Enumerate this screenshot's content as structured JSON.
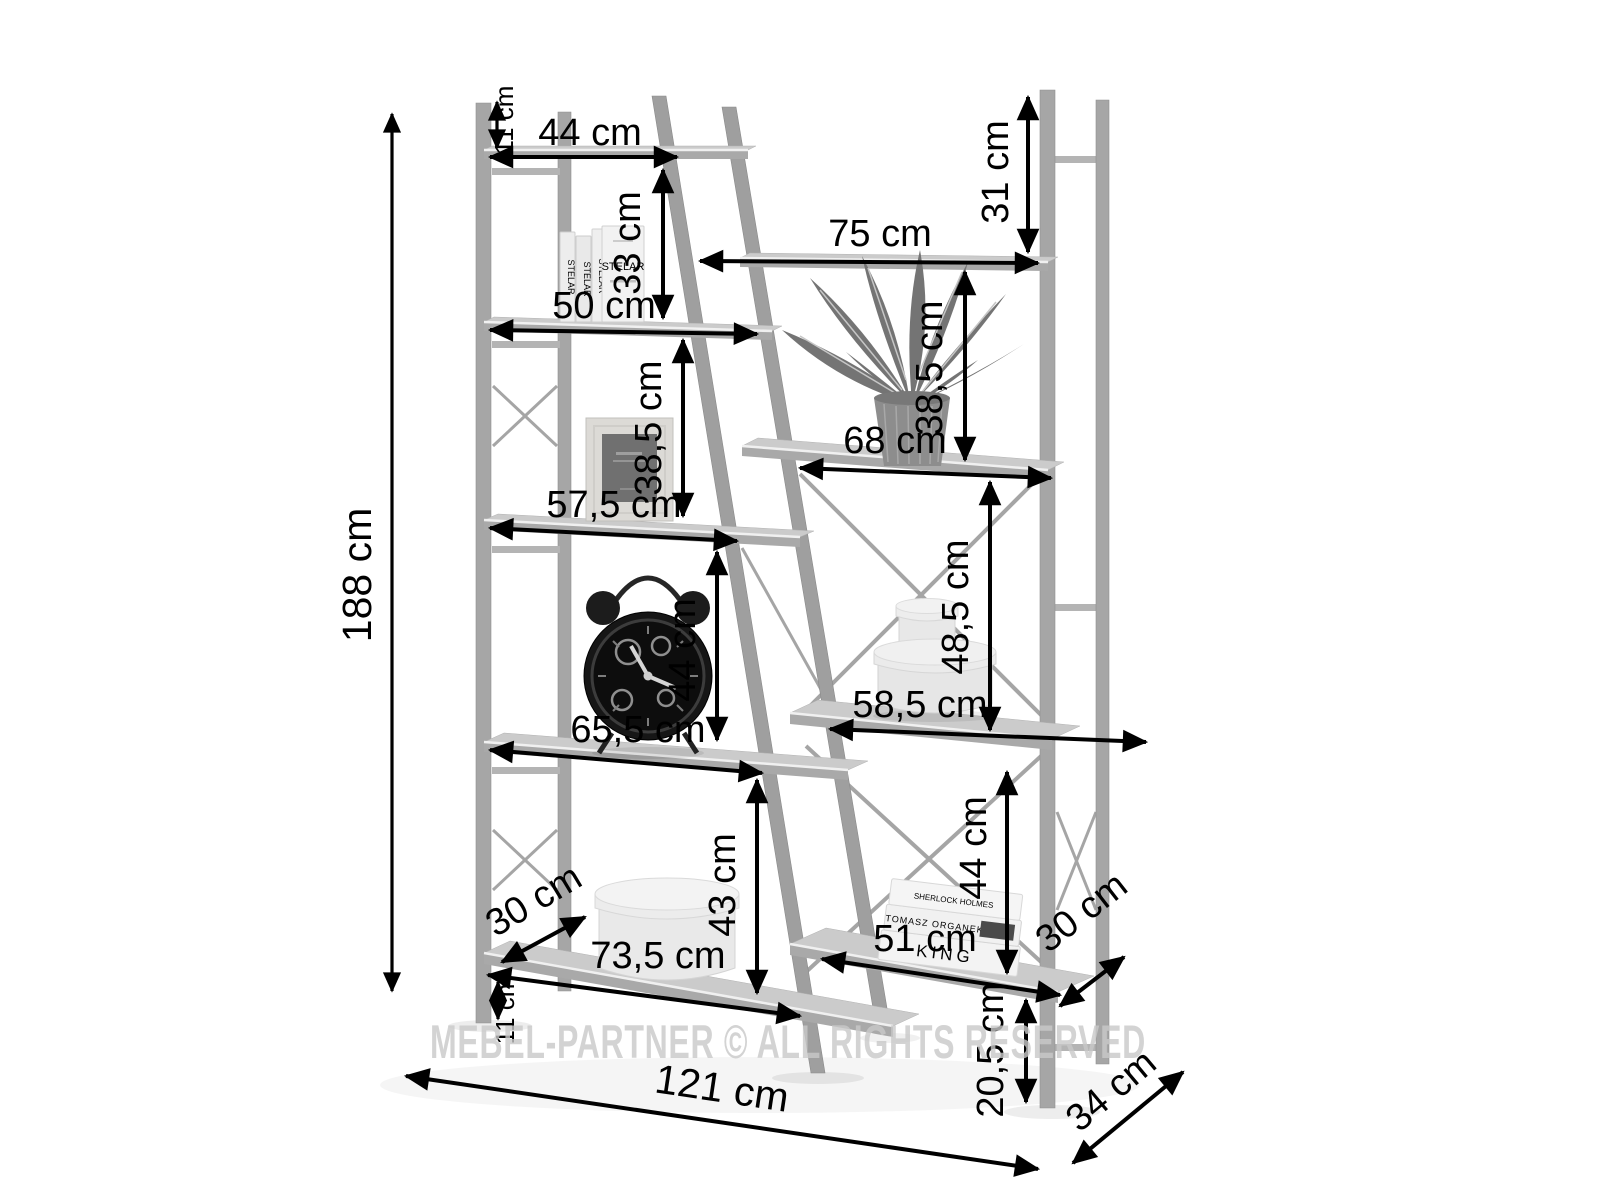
{
  "watermark": "MEBEL-PARTNER © ALL RIGHTS RESERVED",
  "dimensions": {
    "total_height": "188 cm",
    "total_width": "121 cm",
    "total_depth": "34 cm",
    "left_top_offset": "11 cm",
    "left_shelf_1_width": "44 cm",
    "left_gap_1": "33 cm",
    "left_shelf_2_width": "50 cm",
    "left_gap_2": "38,5 cm",
    "left_shelf_3_width": "57,5 cm",
    "left_gap_3": "44 cm",
    "left_shelf_4_width": "65,5 cm",
    "left_gap_4": "43 cm",
    "left_shelf_5_width": "73,5 cm",
    "left_bottom_offset": "11 cm",
    "left_shelf_depth": "30 cm",
    "right_top_offset": "31 cm",
    "right_shelf_1_width": "75 cm",
    "right_gap_1": "38,5 cm",
    "right_shelf_2_width": "68 cm",
    "right_gap_2": "48,5 cm",
    "right_shelf_3_width": "58,5 cm",
    "right_gap_3": "44 cm",
    "right_shelf_4_width": "51 cm",
    "right_bottom_offset": "20,5 cm",
    "right_shelf_depth": "30 cm"
  },
  "decor_text": {
    "standing_book_title": "STELAR",
    "flat_book_top": "SHERLOCK HOLMES",
    "flat_book_middle": "TOMASZ ORGANEK",
    "flat_book_bottom": "KING"
  }
}
